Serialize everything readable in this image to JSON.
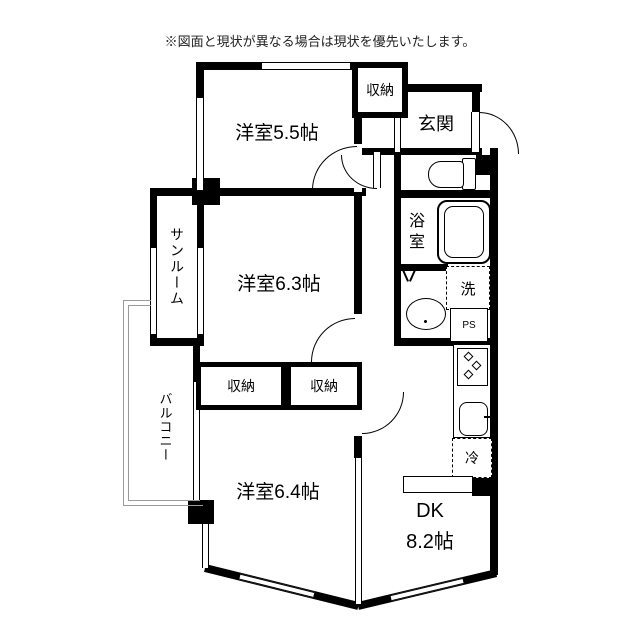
{
  "disclaimer": "※図面と現状が異なる場合は現状を優先いたします。",
  "rooms": {
    "western_room_55": "洋室5.5帖",
    "closet_top": "収納",
    "entrance": "玄関",
    "bathroom": "浴室",
    "laundry": "洗",
    "pipe_space": "PS",
    "sunroom": "サンルーム",
    "western_room_63": "洋室6.3帖",
    "closet_left": "収納",
    "closet_right": "収納",
    "balcony": "バルコニー",
    "western_room_64": "洋室6.4帖",
    "dining_kitchen_name": "DK",
    "dining_kitchen_size": "8.2帖",
    "refrigerator": "冷"
  },
  "colors": {
    "wall": "#000000",
    "balcony_outline": "#9a9a9a",
    "text": "#000000",
    "background": "#ffffff"
  }
}
